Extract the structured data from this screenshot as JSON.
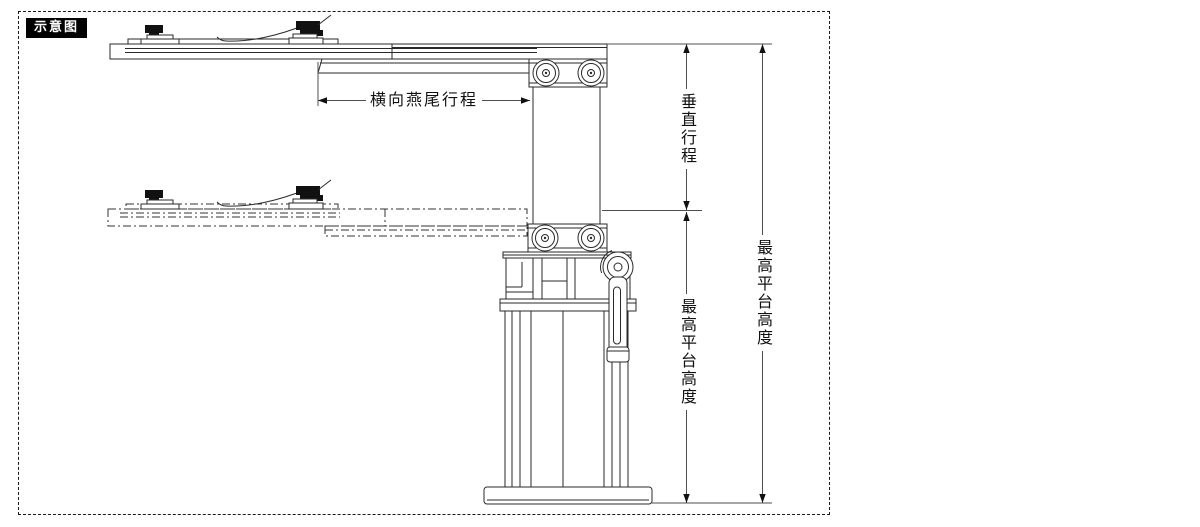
{
  "diagram": {
    "badge_label": "示意图",
    "labels": {
      "dovetail_travel": "横向燕尾行程",
      "vertical_travel": "垂直行程",
      "max_platform_height_mid": "最高平台高度",
      "max_platform_height_right": "最高平台高度"
    },
    "colors": {
      "background": "#ffffff",
      "line_art": "#2a2a2a",
      "dimension_line": "#4f4f4f",
      "arrow": "#111111",
      "badge_background": "#000000",
      "badge_text": "#ffffff"
    }
  }
}
